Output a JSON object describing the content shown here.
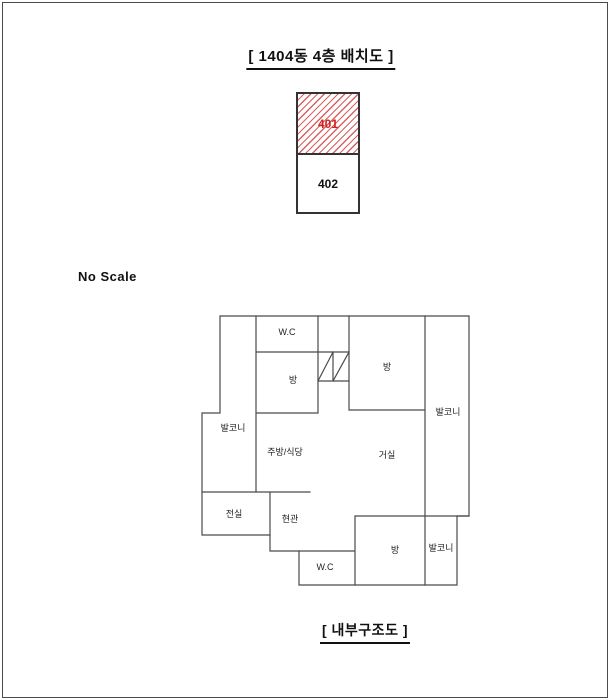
{
  "page": {
    "title_top": "[ 1404동 4층 배치도 ]",
    "title_bottom": "[ 내부구조도 ]",
    "no_scale": "No Scale"
  },
  "layout_plan": {
    "units": [
      {
        "label": "401",
        "highlighted": true
      },
      {
        "label": "402",
        "highlighted": false
      }
    ],
    "highlight_text_color": "#cc2222",
    "hatch_color": "#d96161"
  },
  "floor_plan": {
    "rooms": [
      {
        "label": "W.C"
      },
      {
        "label": "방"
      },
      {
        "label": "방"
      },
      {
        "label": "발코니"
      },
      {
        "label": "발코니"
      },
      {
        "label": "주방/식당"
      },
      {
        "label": "거실"
      },
      {
        "label": "전실"
      },
      {
        "label": "현관"
      },
      {
        "label": "방"
      },
      {
        "label": "발코니"
      },
      {
        "label": "W.C"
      }
    ]
  },
  "colors": {
    "wall_line": "#4a4a4a",
    "unit_border": "#333333",
    "page_border": "#4a4a4a"
  }
}
